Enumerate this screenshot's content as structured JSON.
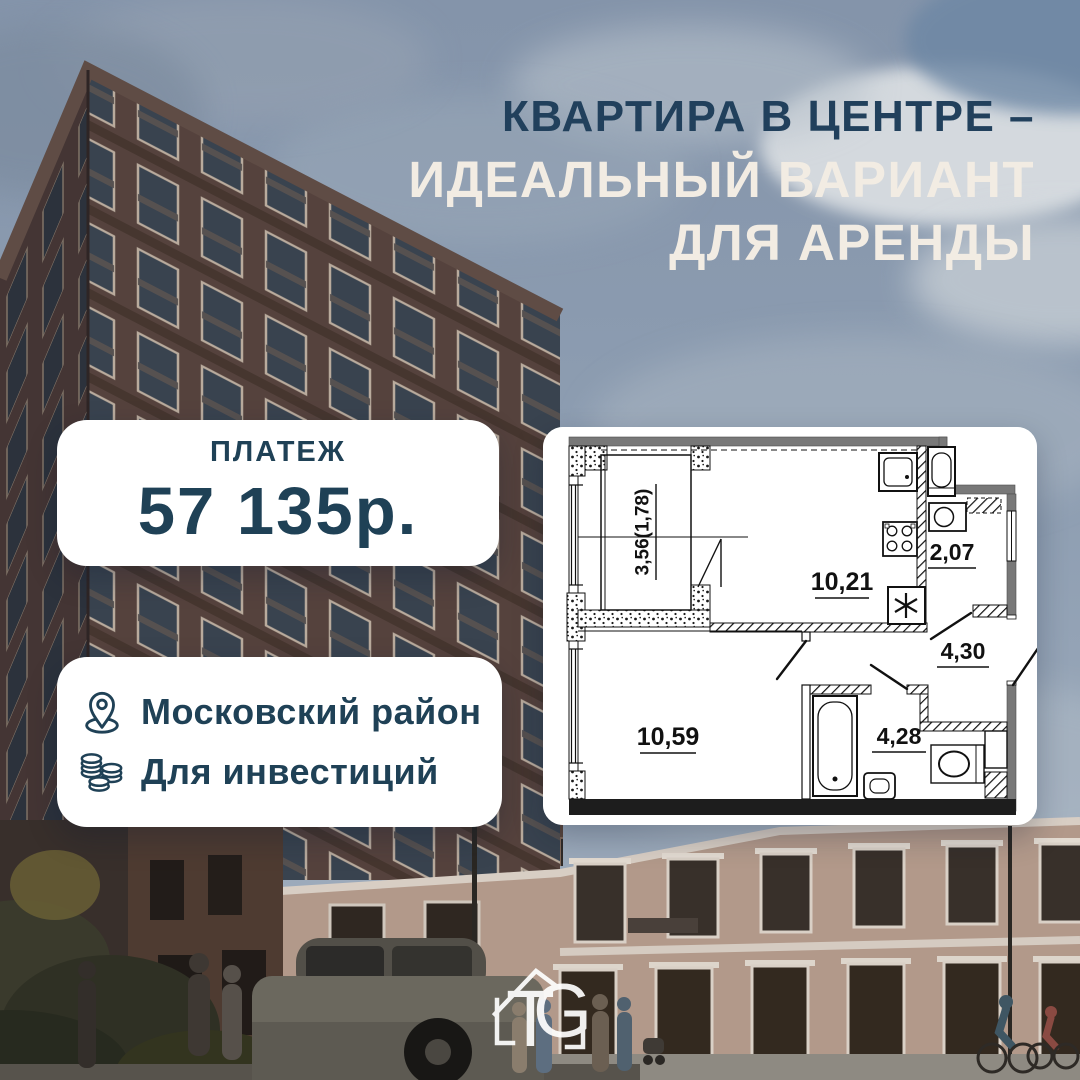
{
  "headline": {
    "line1": "КВАРТИРА В ЦЕНТРЕ –",
    "line2": "ИДЕАЛЬНЫЙ ВАРИАНТ",
    "line3": "ДЛЯ АРЕНДЫ"
  },
  "payment_card": {
    "label": "ПЛАТЕЖ",
    "amount": "57 135р."
  },
  "info_card": {
    "items": [
      {
        "icon": "location-pin-icon",
        "label": "Московский район"
      },
      {
        "icon": "coins-icon",
        "label": "Для инвестиций"
      }
    ]
  },
  "floor_plan": {
    "rooms": [
      {
        "name": "balcony",
        "area_label": "3,56(1,78)"
      },
      {
        "name": "kitchen-living-room",
        "area_label": "10,21"
      },
      {
        "name": "hall",
        "area_label": "2,07"
      },
      {
        "name": "corridor",
        "area_label": "4,30"
      },
      {
        "name": "bedroom",
        "area_label": "10,59"
      },
      {
        "name": "bathroom",
        "area_label": "4,28"
      }
    ]
  },
  "logo": {
    "letter_t": "T",
    "letter_g": "G"
  },
  "colors": {
    "headline_navy": "#21405c",
    "headline_cream": "#f2ece3",
    "card_text_navy": "#1f4156",
    "card_bg": "#ffffff",
    "sky": "#8b9bb0",
    "tower_brick": "#55423d",
    "classical_facade": "#b2998a"
  }
}
